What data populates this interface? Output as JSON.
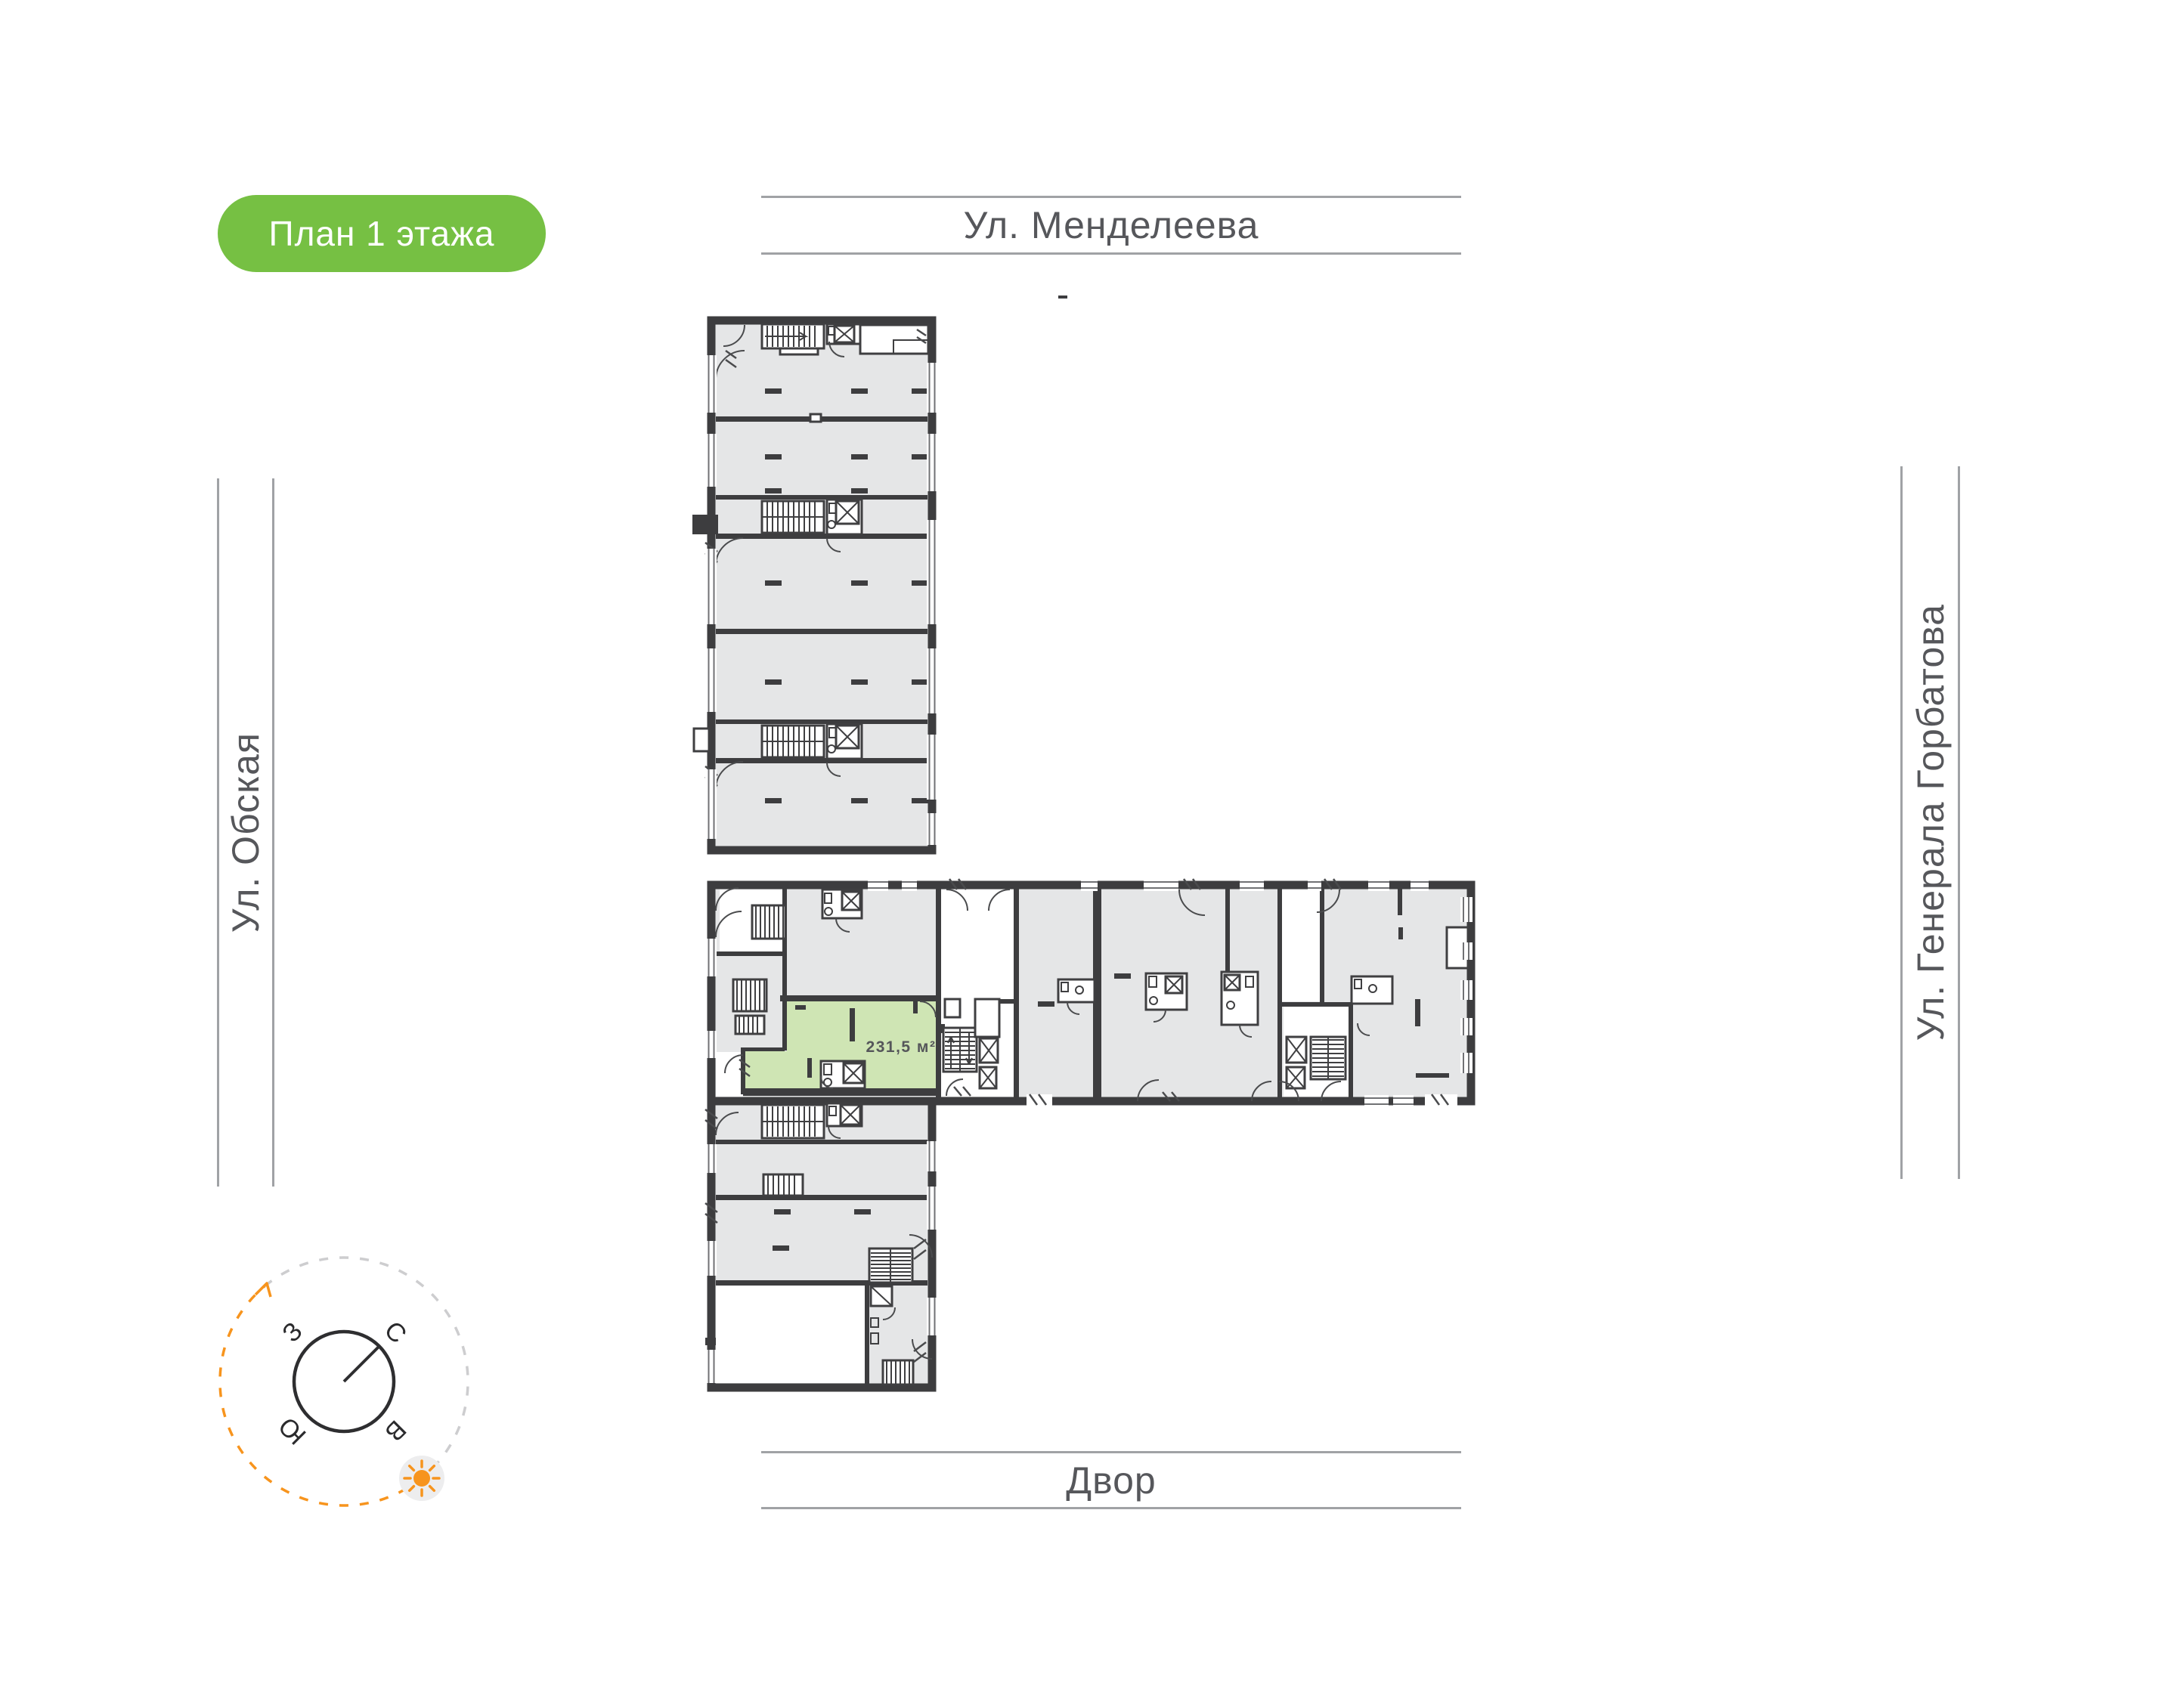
{
  "badge": {
    "label": "План 1 этажа"
  },
  "streets": {
    "top": "Ул. Менделеева",
    "left": "Ул. Обская",
    "right": "Ул. Генерала Горбатова",
    "bottom": "Двор"
  },
  "plan": {
    "highlighted_unit": {
      "area_label": "231,5 м²"
    }
  },
  "compass": {
    "north": "С",
    "east": "В",
    "south": "Ю",
    "west": "З"
  },
  "colors": {
    "badge_green": "#76c043",
    "highlight_green": "#cfe5b4",
    "compass_orange": "#f7941d"
  }
}
